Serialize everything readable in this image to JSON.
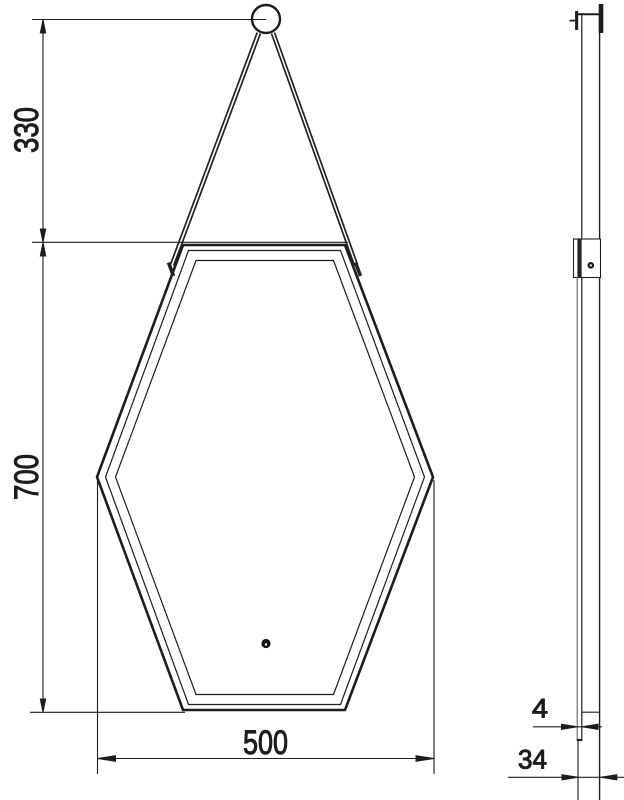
{
  "drawing": {
    "subject": "hexagonal mirror technical drawing - front and side view",
    "background_color": "#ffffff",
    "line_color": "#1d1d1d",
    "secondary_line_color": "#8a8a8a"
  },
  "dimensions": {
    "strap_drop": {
      "value": "330"
    },
    "mirror_height": {
      "value": "700"
    },
    "mirror_width": {
      "value": "500"
    },
    "frame_lip_depth": {
      "value": "4"
    },
    "total_depth": {
      "value": "34"
    }
  }
}
